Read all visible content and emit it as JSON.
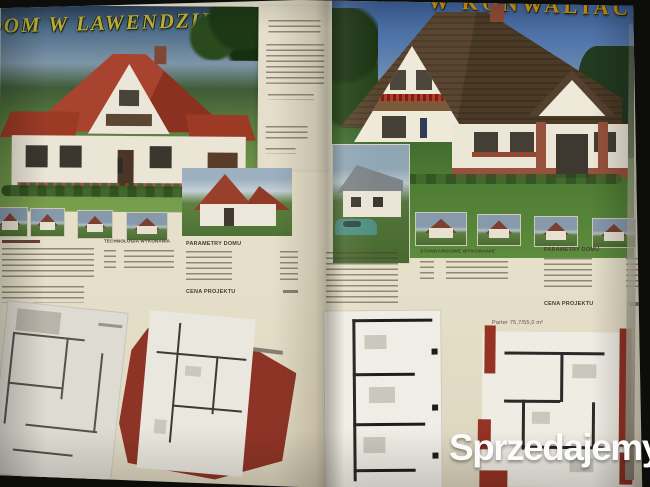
{
  "left_page": {
    "title": "DOM W LAWENDZIE",
    "specs": {
      "col2_header": "TECHNOLOGIA WYKONANIA",
      "col3_header": "PARAMETRY DOMU",
      "price_label": "CENA PROJEKTU"
    }
  },
  "right_page": {
    "title": "W KONWALIACH",
    "specs": {
      "col1_header": "STANDARDOWE WYKONANIE",
      "col2_header": "PARAMETRY DOMU",
      "price_label": "CENA PROJEKTU"
    },
    "plan_label": "Parter 75,7/55,0 m²"
  },
  "watermark": {
    "text": "Sprzedajemy",
    "badge": ".pl"
  },
  "colors": {
    "paper": "#e7e1cc",
    "roof_red": "#9c3a26",
    "roof_brown": "#54412d",
    "plan_red": "#8e3426",
    "watermark_badge": "#cf3f2c",
    "title_left": "#bfae39",
    "title_right": "#c8920f"
  }
}
